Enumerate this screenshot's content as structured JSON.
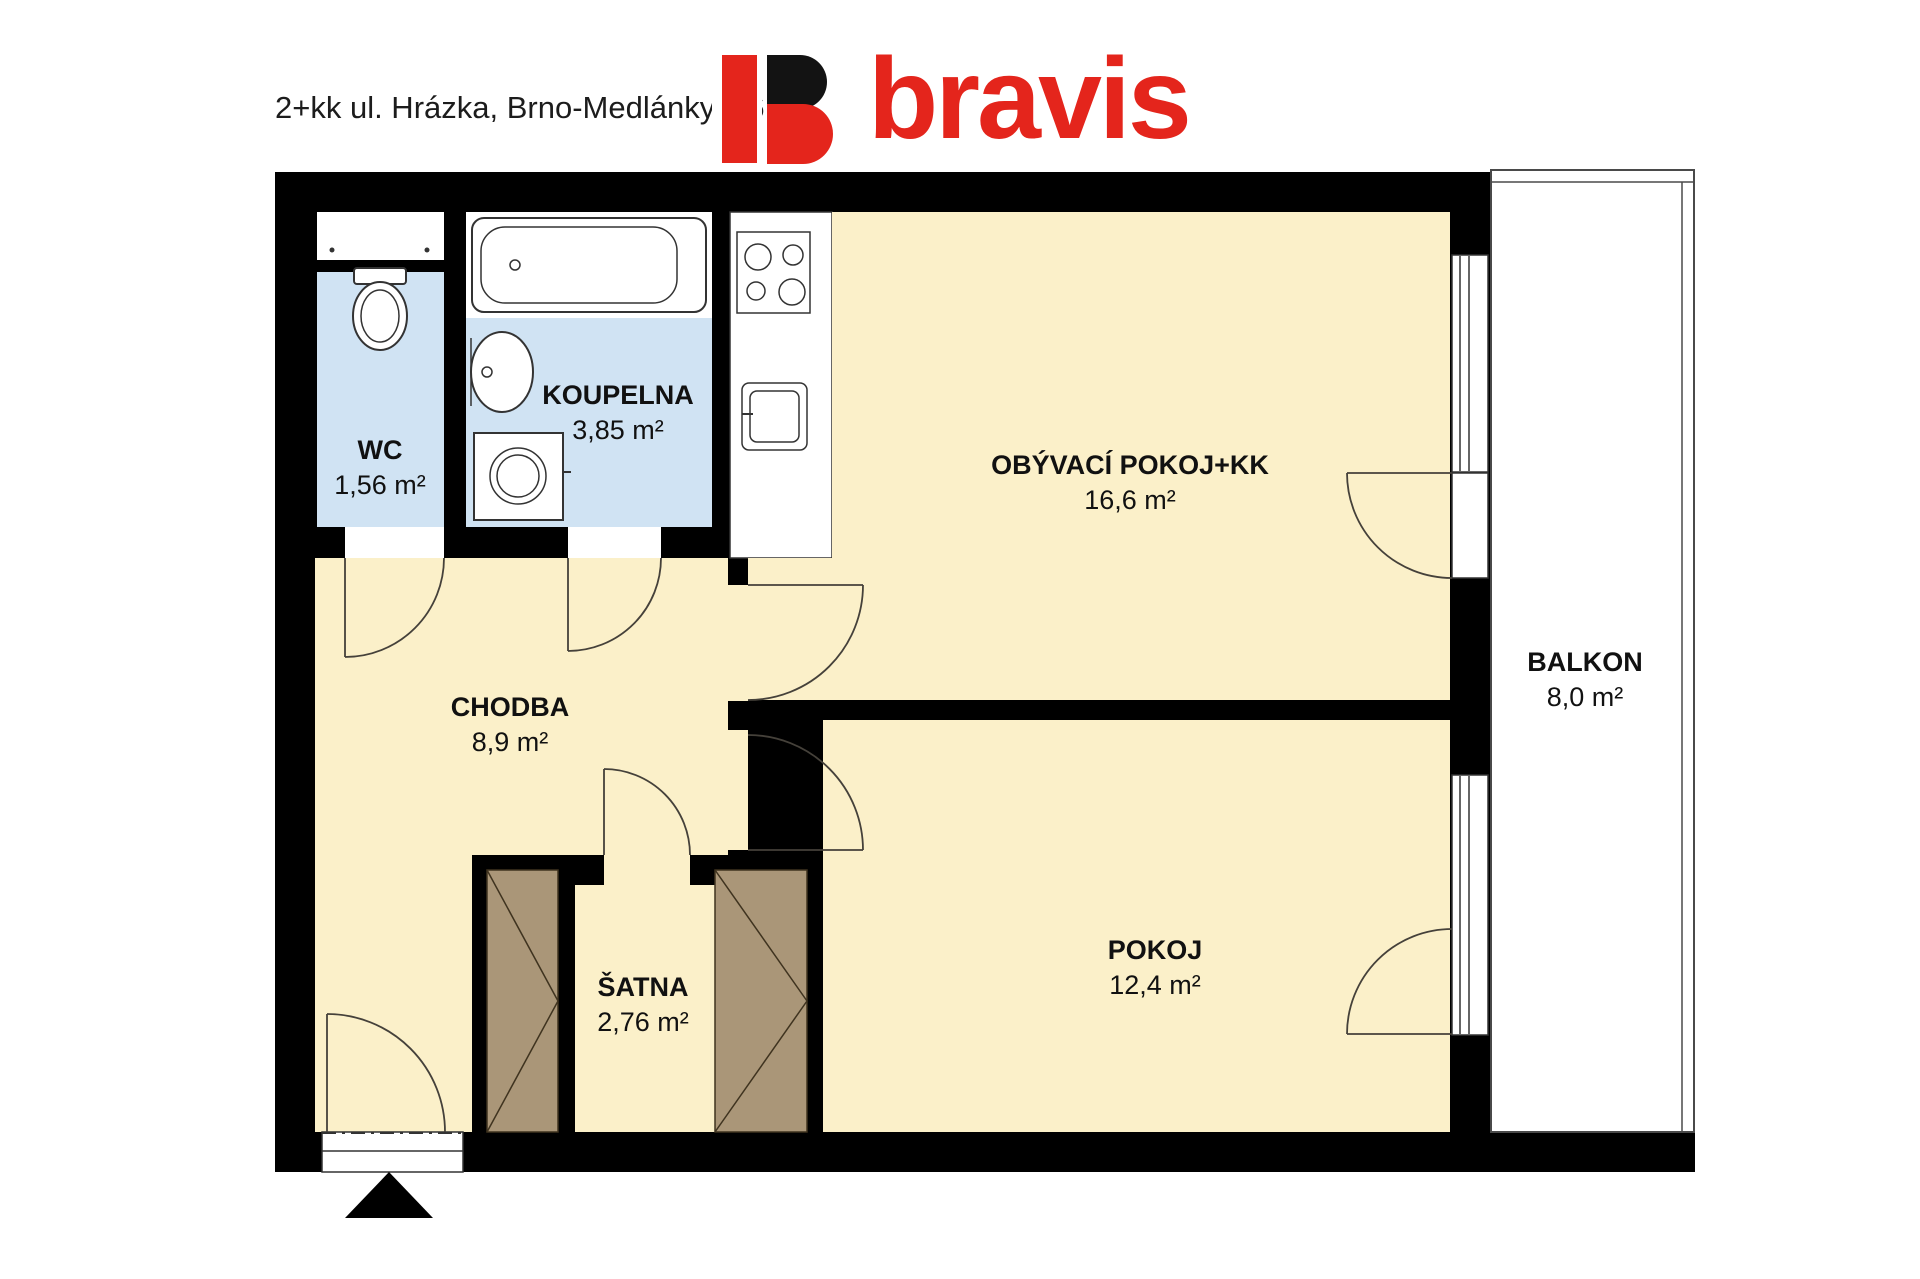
{
  "header": {
    "title": "2+kk ul. Hrázka, Brno-Medlánky, 46 m²",
    "logo_text": "bravis"
  },
  "floorplan": {
    "rooms": [
      {
        "id": "wc",
        "label": "WC",
        "area": "1,56 m²"
      },
      {
        "id": "koupelna",
        "label": "KOUPELNA",
        "area": "3,85 m²"
      },
      {
        "id": "obyvaci",
        "label": "OBÝVACÍ POKOJ+KK",
        "area": "16,6 m²"
      },
      {
        "id": "chodba",
        "label": "CHODBA",
        "area": "8,9 m²"
      },
      {
        "id": "satna",
        "label": "ŠATNA",
        "area": "2,76 m²"
      },
      {
        "id": "pokoj",
        "label": "POKOJ",
        "area": "12,4 m²"
      },
      {
        "id": "balkon",
        "label": "BALKON",
        "area": "8,0 m²"
      }
    ],
    "fixtures": [
      "toilet-icon",
      "bathtub-icon",
      "washbasin-icon",
      "washing-machine-icon",
      "stove-icon",
      "kitchen-sink-icon",
      "wardrobe-icon",
      "wardrobe-icon",
      "entrance-arrow-icon"
    ],
    "colors": {
      "wall_black": "#000000",
      "room_yellow": "#fbf0c9",
      "room_blue": "#d0e3f3",
      "wardrobe_brown": "#aa9678",
      "logo_red": "#e4251c"
    }
  }
}
